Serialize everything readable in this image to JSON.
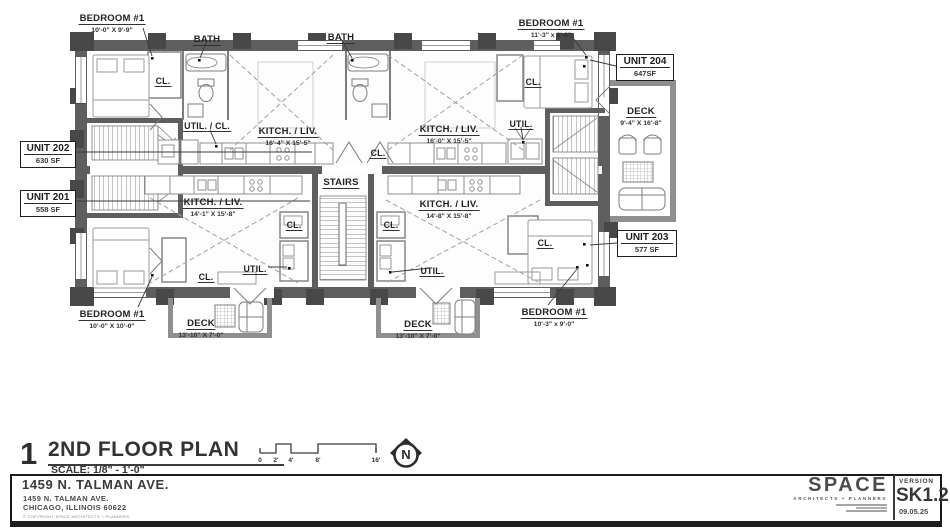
{
  "plan": {
    "number": "1",
    "title": "2ND FLOOR PLAN",
    "scale_label": "SCALE: 1/8\" - 1'-0\"",
    "scale_ticks": [
      "0",
      "2'",
      "4'",
      "8'",
      "16'"
    ],
    "north_letter": "N"
  },
  "units": {
    "u201": {
      "name": "UNIT 201",
      "area": "558 SF"
    },
    "u202": {
      "name": "UNIT 202",
      "area": "630 SF"
    },
    "u203": {
      "name": "UNIT 203",
      "area": "577 SF"
    },
    "u204": {
      "name": "UNIT 204",
      "area": "647SF"
    }
  },
  "rooms": {
    "bedroom_tl": {
      "name": "BEDROOM #1",
      "dims": "10'-0\" X 9'-9\""
    },
    "bedroom_tr": {
      "name": "BEDROOM #1",
      "dims": "11'-3\" x 8'-8\""
    },
    "bedroom_bl": {
      "name": "BEDROOM #1",
      "dims": "10'-0\" X 10'-0\""
    },
    "bedroom_br": {
      "name": "BEDROOM #1",
      "dims": "10'-3\" x 9'-0\""
    },
    "bath": "BATH",
    "kitch_202": {
      "name": "KITCH. / LIV.",
      "dims": "16'-4\" X 15'-5\""
    },
    "kitch_204": {
      "name": "KITCH. / LIV.",
      "dims": "16'-0\" X 15'-5\""
    },
    "kitch_201": {
      "name": "KITCH. / LIV.",
      "dims": "14'-1\" X 15'-8\""
    },
    "kitch_203": {
      "name": "KITCH. / LIV.",
      "dims": "14'-8\" X 15'-8\""
    },
    "deck_right": {
      "name": "DECK",
      "dims": "9'-4\" X 16'-8\""
    },
    "deck_bl": {
      "name": "DECK",
      "dims": "13'-10\" X 7'-0\""
    },
    "deck_bm": {
      "name": "DECK",
      "dims": "13'-10\" X 7'-0\""
    },
    "stairs": "STAIRS",
    "util_cl": "UTIL. / CL.",
    "util": "UTIL.",
    "cl": "CL."
  },
  "titleblock": {
    "project": "1459 N. TALMAN AVE.",
    "address1": "1459 N. TALMAN AVE.",
    "address2": "CHICAGO, ILLINOIS 60622",
    "copyright": "© COPYRIGHT SPACE ARCHITECTS + PLANNERS",
    "firm": "SPACE",
    "firm_sub": "ARCHITECTS + PLANNERS",
    "version_label": "VERSION",
    "sheet": "SK1.2",
    "date": "09.05.25"
  }
}
